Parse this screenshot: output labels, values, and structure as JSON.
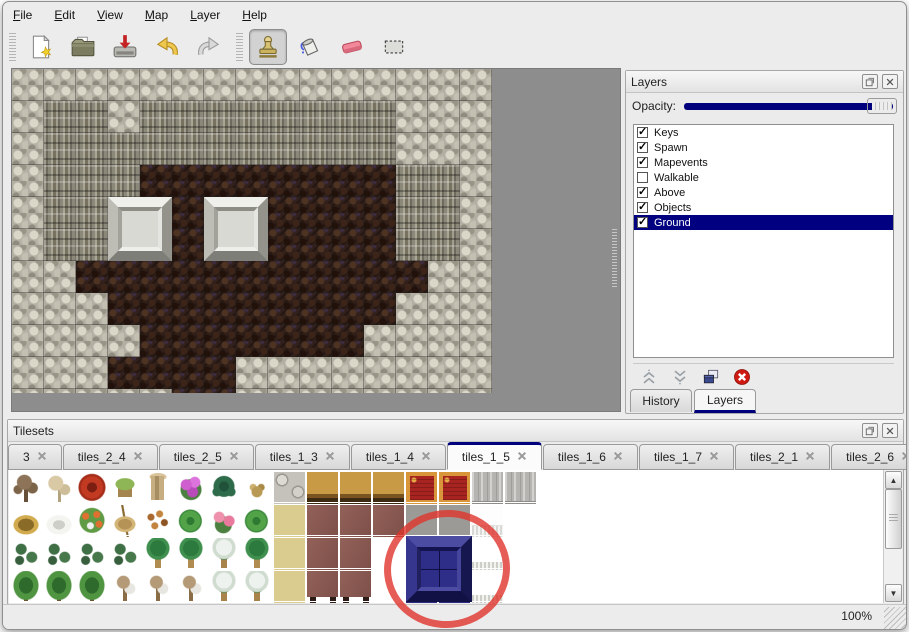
{
  "menu_bar": {
    "items": [
      "File",
      "Edit",
      "View",
      "Map",
      "Layer",
      "Help"
    ]
  },
  "toolbar": {
    "buttons": [
      {
        "icon": "new-file-icon",
        "group": 1,
        "active": false
      },
      {
        "icon": "open-folder-icon",
        "group": 1,
        "active": false
      },
      {
        "icon": "save-icon",
        "group": 1,
        "active": false
      },
      {
        "icon": "undo-icon",
        "group": 1,
        "active": false
      },
      {
        "icon": "redo-icon",
        "group": 1,
        "active": false
      },
      {
        "icon": "stamp-tool-icon",
        "group": 2,
        "active": true
      },
      {
        "icon": "fill-tool-icon",
        "group": 2,
        "active": false
      },
      {
        "icon": "eraser-tool-icon",
        "group": 2,
        "active": false
      },
      {
        "icon": "select-tool-icon",
        "group": 2,
        "active": false
      }
    ]
  },
  "map": {
    "tile_size": 32,
    "grid": [
      "RRRRRRRRRRRRRRR",
      "RCCRCCCCCCCCRRR",
      "RCCCCCCCCCCCRRR",
      "RCCCBBBBBBBBCCR",
      "RCCBBBBBBBBBCCR",
      "RCCBBBBBBBBBCCR",
      "RRBBBBBBBBBBBRR",
      "RRRBBBBBBBBBRRR",
      "RRRRBBBBBBBRRRR",
      "RRRBBBBRRRRRRRR",
      "RRRRRBBRRRRRRRR"
    ],
    "legend": {
      "R": "gray-rubble-rock",
      "C": "cliff-face",
      "B": "brown-cave-floor"
    },
    "blocks": [
      {
        "col": 3,
        "row": 4
      },
      {
        "col": 6,
        "row": 4
      }
    ]
  },
  "layers_panel": {
    "title": "Layers",
    "opacity_label": "Opacity:",
    "opacity_value": 100,
    "layers": [
      {
        "name": "Keys",
        "checked": true,
        "selected": false
      },
      {
        "name": "Spawn",
        "checked": true,
        "selected": false
      },
      {
        "name": "Mapevents",
        "checked": true,
        "selected": false
      },
      {
        "name": "Walkable",
        "checked": false,
        "selected": false
      },
      {
        "name": "Above",
        "checked": true,
        "selected": false
      },
      {
        "name": "Objects",
        "checked": true,
        "selected": false
      },
      {
        "name": "Ground",
        "checked": true,
        "selected": true
      }
    ],
    "tabs": [
      "History",
      "Layers"
    ],
    "active_tab": "Layers",
    "selection_color": "#000080"
  },
  "tilesets_panel": {
    "title": "Tilesets",
    "tabs": [
      "3",
      "tiles_2_4",
      "tiles_2_5",
      "tiles_1_3",
      "tiles_1_4",
      "tiles_1_5",
      "tiles_1_6",
      "tiles_1_7",
      "tiles_2_1",
      "tiles_2_6"
    ],
    "active_tab": "tiles_1_5",
    "tile_grid": [
      [
        "dt",
        "cb",
        "rf",
        "st",
        "ts",
        "pf",
        "dp",
        "dr",
        "stf",
        "wtb",
        "wtb",
        "wtb",
        "rcp",
        "rcp",
        "gst",
        "gst",
        "wht"
      ],
      [
        "hy",
        "sm",
        "fp",
        "dg",
        "lv",
        "lp",
        "pk",
        "lp",
        "tan",
        "bch",
        "bch",
        "bch",
        "gpl",
        "gpl",
        "wcp",
        "wht",
        "wht"
      ],
      [
        "bs",
        "bs",
        "bs",
        "bs",
        "pm",
        "pm",
        "sp",
        "pm",
        "tan",
        "bch",
        "bch",
        "wht",
        "blu",
        "blu",
        "wcf",
        "wht",
        "wht"
      ],
      [
        "gt",
        "gt",
        "gt",
        "bt",
        "bt",
        "bt",
        "sp",
        "sp",
        "tan",
        "bcb",
        "bcb",
        "wht",
        "blu",
        "blu",
        "wcf",
        "wht",
        "wht"
      ],
      [
        "gt",
        "gt",
        "gt",
        "bt",
        "bt",
        "bt",
        "dp",
        "sp",
        "tan",
        "bch",
        "bch",
        "wht",
        "wht",
        "wht",
        "wht",
        "wht",
        "wht"
      ]
    ],
    "selected_tile": {
      "cols": [
        12,
        13
      ],
      "rows": [
        2,
        3
      ],
      "color": "#2b2b84"
    }
  },
  "annotation": {
    "shape": "hand-drawn-red-circle",
    "color": "#de342c",
    "marks": "selected blue tile in tileset"
  },
  "status_bar": {
    "zoom": "100%"
  }
}
